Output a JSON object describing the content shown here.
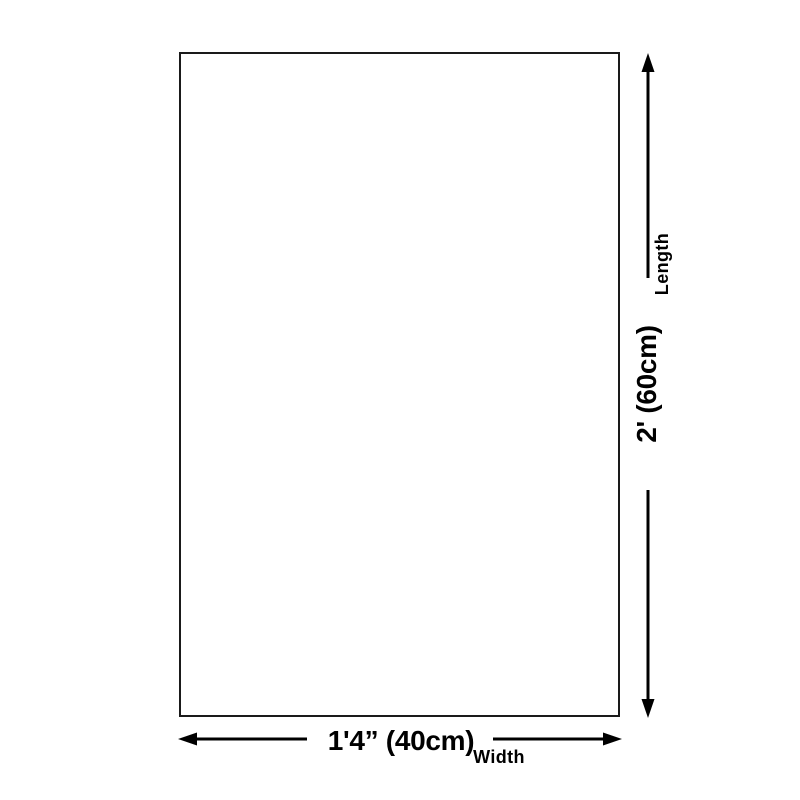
{
  "dimensions": {
    "length": {
      "label": "Length",
      "value": "2' (60cm)"
    },
    "width": {
      "label": "Width",
      "value": "1'4” (40cm)"
    }
  },
  "icons": {
    "length_arrow": "vertical-double-arrow",
    "width_arrow": "horizontal-double-arrow"
  },
  "colors": {
    "background": "#ffffff",
    "outline": "#1a1a1a",
    "arrow": "#000000",
    "text": "#000000"
  }
}
